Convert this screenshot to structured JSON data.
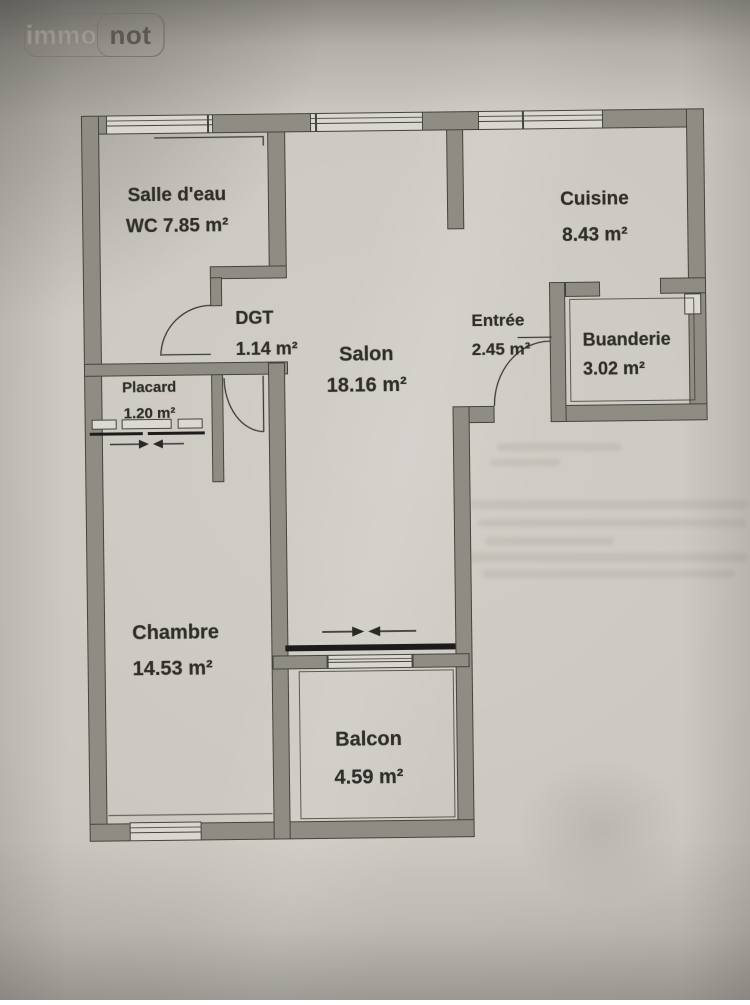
{
  "logo": {
    "immo": "immo",
    "not": "not"
  },
  "rooms": [
    {
      "name": "Salle d'eau",
      "area": "WC 7.85 m²"
    },
    {
      "name": "Cuisine",
      "area": "8.43 m²"
    },
    {
      "name": "DGT",
      "area": "1.14 m²"
    },
    {
      "name": "Salon",
      "area": "18.16 m²"
    },
    {
      "name": "Entrée",
      "area": "2.45 m²"
    },
    {
      "name": "Buanderie",
      "area": "3.02 m²"
    },
    {
      "name": "Placard",
      "area": "1.20 m²"
    },
    {
      "name": "Chambre",
      "area": "14.53 m²"
    },
    {
      "name": "Balcon",
      "area": "4.59 m²"
    }
  ],
  "colors": {
    "paper": "#ccc8c1",
    "wall": "#8f8c84",
    "line": "#45433e",
    "ink": "#2f2e2a",
    "slide": "#1d1c1a"
  }
}
